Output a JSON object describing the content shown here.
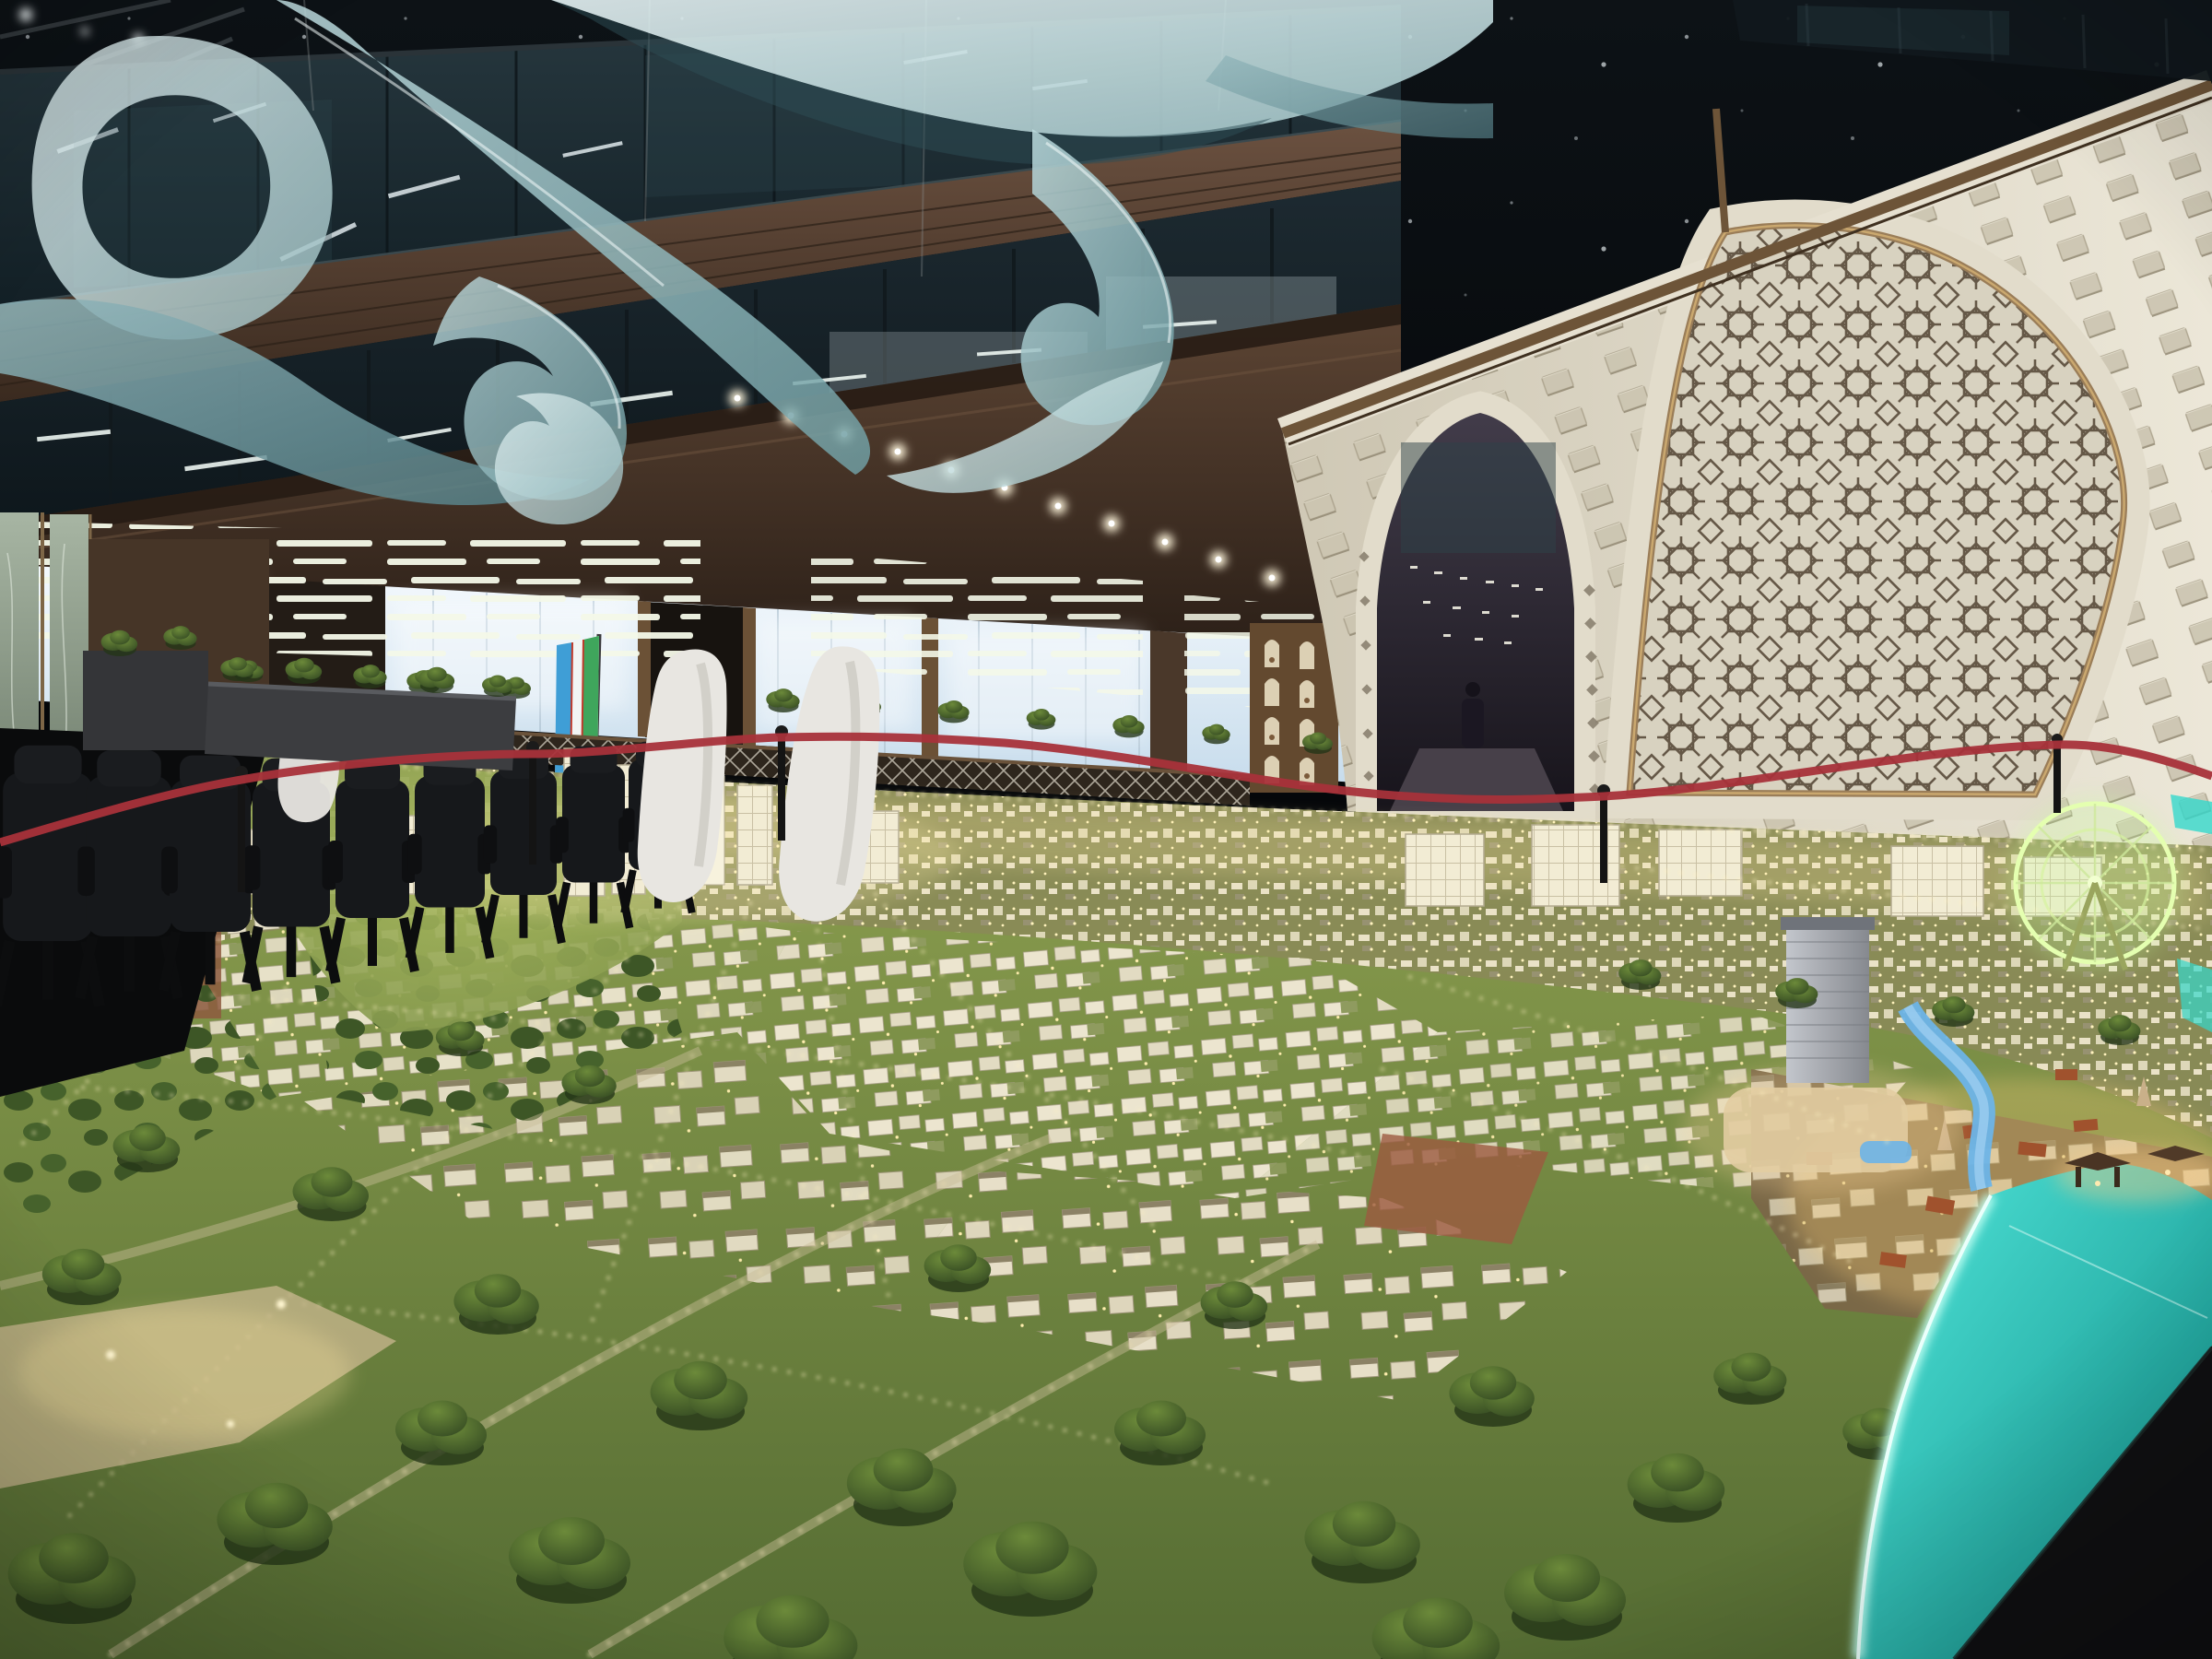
{
  "scene": {
    "labels": {
      "canvas": "Exhibition hall atrium with illuminated city scale model",
      "ceiling": "Dark atrium ceiling with small downlights",
      "ribbon": "Suspended translucent teal ribbon sculpture",
      "mezzanine": "Glass-fronted mezzanine levels with interior lighting",
      "ground_floor": "Frosted window wall with staggered LED light strips",
      "right_wall": "Cream wall with recessed squares and Islamic girih arch panel",
      "doorway": "Pointed arch passage with visitor silhouette",
      "flag": "Uzbekistan flag on pole",
      "model": "Illuminated miniature city model with parks and lake",
      "cbd": "High-rise cluster with spire tower",
      "ferris_wheel": "Glowing ferris wheel",
      "old_town": "Warm-lit historic quarter",
      "lake": "Glowing turquoise lake edge",
      "chairs": "Row of black office chairs",
      "white_chairs": "White sculptural seats",
      "planters": "Dark planter boxes with greenery",
      "barrier": "Red rope barrier with black posts",
      "lattice": "White mashrabiya lattice fence",
      "niche_unit": "Display cabinet with arched niches"
    },
    "counts": {
      "downlights": 11,
      "office_chairs": 9,
      "white_chairs": 3,
      "rope_posts": 5
    }
  },
  "colors": {
    "ceiling": "#0a0d10",
    "fascia": "#5a4330",
    "fasciaDark": "#33251b",
    "windowGlow": "#e9f3fa",
    "bronze": "#8a6f4e",
    "wallCream": "#e6e1d1",
    "wallShadow": "#c6bfab",
    "girihLine": "#5f5140",
    "girihBg": "#d8d2c0",
    "archDark": "#2a2530",
    "ribbonLight": "#d8eef0",
    "ribbonDeep": "#6f9da2",
    "lawn": "#7d914a",
    "lawnDark": "#5d7337",
    "tree": "#3c5524",
    "cityLight": "#fff3c2",
    "buildingCream": "#efe8d2",
    "lakeBright": "#bffff2",
    "lake": "#23c9bd",
    "lakeDeep": "#0e8f88",
    "tableDark": "#101012",
    "rope": "#a8323a",
    "post": "#141414",
    "chair": "#16181b",
    "whiteChair": "#e8e6e1",
    "flagBlue": "#3f9ed6",
    "flagGreen": "#3fa65c",
    "flagWhite": "#f2f5f4",
    "marble": "#8fa092",
    "river": "#6db4e8"
  }
}
